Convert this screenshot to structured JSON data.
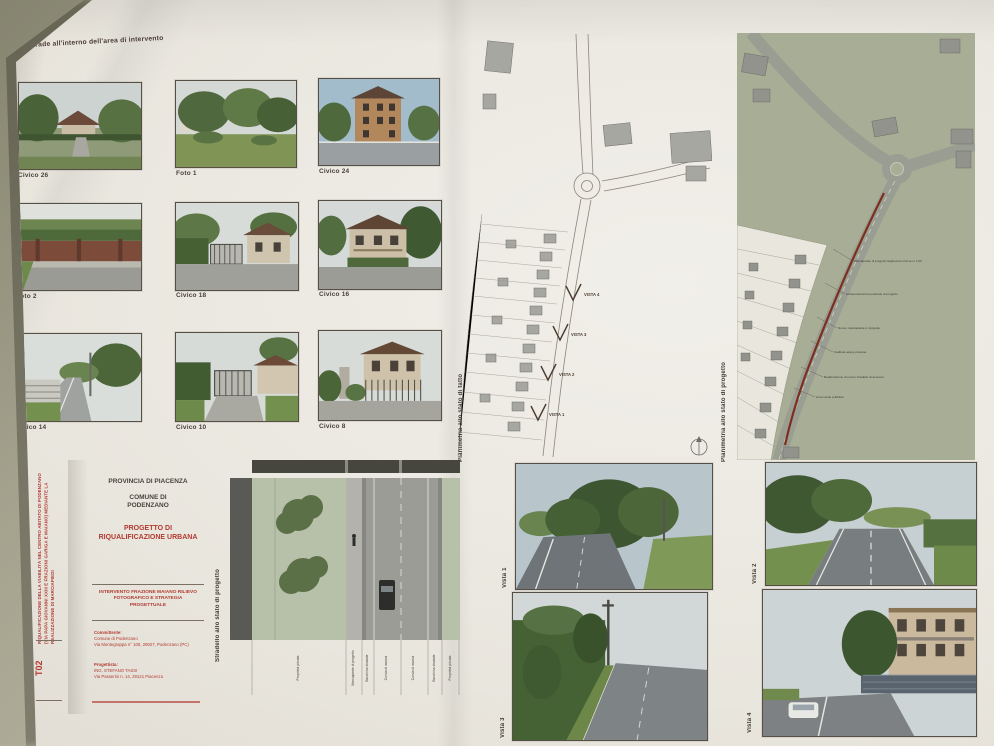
{
  "poster_title": "Strade all'interno dell'area di intervento",
  "colors": {
    "wall": "#b0ae9a",
    "paper": "#ece9e1",
    "accent_red": "#b23a30",
    "plan_green": "#a8ae96",
    "road_gray": "#9a9e92"
  },
  "gallery": {
    "items": [
      {
        "label": "Civico 26"
      },
      {
        "label": "Foto 1"
      },
      {
        "label": "Civico 24"
      },
      {
        "label": "Foto 2"
      },
      {
        "label": "Civico 18"
      },
      {
        "label": "Civico 16"
      },
      {
        "label": "Civico 14"
      },
      {
        "label": "Civico 10"
      },
      {
        "label": "Civico 8"
      }
    ]
  },
  "plan_fatto": {
    "caption": "Planimetria allo stato di fatto",
    "markers": [
      "VISTA 4",
      "VISTA 3",
      "VISTA 2",
      "VISTA 1"
    ]
  },
  "plan_progetto": {
    "caption": "Planimetria allo stato di progetto",
    "annotations": [
      "Marciapiede di progetto larghezza minima m 1,50",
      "Attraversamento pedonale di progetto",
      "Nuovo marciapiede in progetto",
      "Caditoie acque piovane",
      "Realizzazione di nuovo stradello di accesso",
      "Area verde pubblica"
    ]
  },
  "titleblock": {
    "provincia": "PROVINCIA DI PIACENZA",
    "comune": "COMUNE DI PODENZANO",
    "progetto": "PROGETTO DI RIQUALIFICAZIONE URBANA",
    "intervento": "INTERVENTO FRAZIONE MAIANO RILIEVO FOTOGRAFICO E STRATEGIA PROGETTUALE",
    "committente_label": "Committente:",
    "committente_1": "Comune di Podenzano",
    "committente_2": "Via Montegrappa n° 100, 29027, Podenzano (PC)",
    "progettista_label": "Progettista:",
    "progettista_1": "ING. STEFANO TASSI",
    "progettista_2": "Via Passerini n. 14, 29121 Piacenza",
    "tavola": "T02",
    "oggetto_laterale": "RIQUALIFICAZIONE DELLA VIABILITÀ NEL CENTRO ABITATO DI PODENZANO (VIA PAPA GIOVANNI XXIII E FRAZIONI GARIGA E MAIANO) MEDIANTE LA REALIZZAZIONE DI MARCIAPIEDI"
  },
  "section": {
    "caption": "Stradello allo stato di progetto",
    "zones": [
      "Proprietà privata",
      "Marciapiede di progetto",
      "Banchina stradale",
      "Corsia di marcia",
      "Corsia di marcia",
      "Banchina stradale",
      "Proprietà privata"
    ]
  },
  "vistas": {
    "labels": [
      "Vista 1",
      "Vista 2",
      "Vista 3",
      "Vista 4"
    ]
  }
}
